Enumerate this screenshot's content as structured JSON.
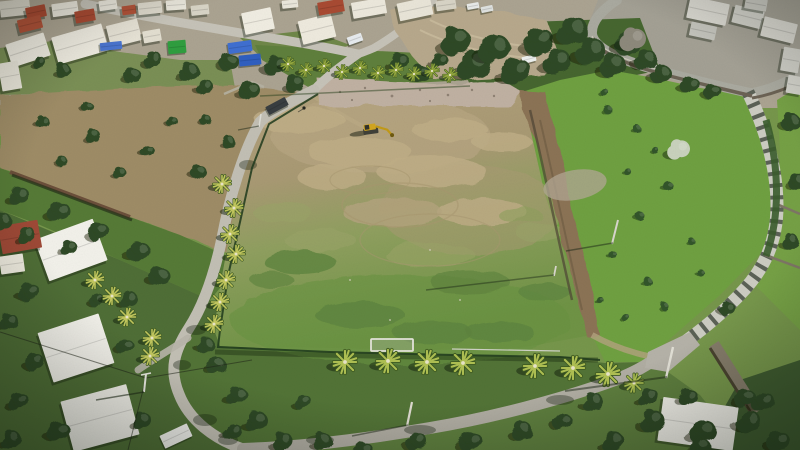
{
  "scene": {
    "type": "aerial-drone-photograph",
    "description": "Aerial drone view of a large cleared dirt and grass field ringed by palm trees and a chain-link fence, with a yellow excavator working near rubble at the top of the plot. A narrow road runs down the left side and curves around the bottom past white villas with red-roofed houses; on the right a stepped stone street descends between terraced gardens and bright green scrubland toward a white flat-roofed villa.",
    "lighting": "bright daylight, shadows falling to the lower-left",
    "landmarks": {
      "main_field": "large cleared plot, brown dirt upper half and patchy green lower half",
      "excavator": {
        "x": 371,
        "y": 129
      },
      "rubble_strip": "pinkish demolition debris along the top edge of the field",
      "goal_frame": {
        "x": 392,
        "y": 345
      },
      "stepped_street": "striped stone stairway street on the right side",
      "person": {
        "x": 304,
        "y": 109
      }
    }
  },
  "palette": {
    "field_dirt": "#b1a07c",
    "field_grass": "#6f9345",
    "scrub_green": "#6fa041",
    "tree_dark": "#2e4a25",
    "palm_light": "#b9c455",
    "road_concrete": "#c6c3b8",
    "road_asphalt": "#aaa79c",
    "building_white": "#f0ede2",
    "roof_red": "#a84a32",
    "rubble_pink": "#c0b1a2",
    "tarp_blue": "#3f6fd1",
    "container_green": "#2f9e3f",
    "excavator_yellow": "#d2a51f"
  },
  "instances": {
    "buildings": {
      "symbol": "box",
      "name": "building",
      "shadow": 2.5,
      "color": "#efece1",
      "items": [
        [
          15,
          8,
          30,
          16,
          -6,
          "#dcd8cb"
        ],
        [
          36,
          12,
          20,
          12,
          -12,
          "#a84a32"
        ],
        [
          30,
          24,
          24,
          13,
          -14,
          "#b05238"
        ],
        [
          65,
          9,
          26,
          13,
          -8,
          "#eae7dc"
        ],
        [
          85,
          16,
          20,
          12,
          -10,
          "#a84a32"
        ],
        [
          108,
          5,
          18,
          10,
          -8,
          "#eae7dc"
        ],
        [
          129,
          10,
          14,
          9,
          -8,
          "#b05238"
        ],
        [
          150,
          8,
          24,
          12,
          -6,
          "#dcd8cb"
        ],
        [
          176,
          5,
          20,
          10,
          -4,
          "#eae7dc"
        ],
        [
          200,
          10,
          18,
          10,
          -6,
          "#d8d4c6"
        ],
        [
          28,
          50,
          40,
          24,
          -18,
          "#efece1"
        ],
        [
          80,
          44,
          52,
          28,
          -16,
          "#efece1"
        ],
        [
          124,
          33,
          32,
          22,
          -14,
          "#e6e2d5"
        ],
        [
          10,
          76,
          20,
          28,
          -10,
          "#e9e6da"
        ],
        [
          152,
          36,
          18,
          12,
          -10,
          "#e2ded0"
        ],
        [
          258,
          21,
          30,
          22,
          -12,
          "#f0ede2"
        ],
        [
          317,
          29,
          34,
          24,
          -14,
          "#eeeade"
        ],
        [
          331,
          7,
          26,
          13,
          -10,
          "#a84a32"
        ],
        [
          369,
          8,
          34,
          16,
          -10,
          "#ece8dc"
        ],
        [
          415,
          9,
          34,
          18,
          -12,
          "#e9e5d8"
        ],
        [
          446,
          5,
          20,
          10,
          -8,
          "#d8d4c6"
        ],
        [
          290,
          4,
          16,
          8,
          -6,
          "#eae7dc"
        ],
        [
          708,
          11,
          40,
          22,
          12,
          "#d8d7cf"
        ],
        [
          748,
          17,
          30,
          18,
          14,
          "#cfcfc7"
        ],
        [
          779,
          30,
          34,
          20,
          14,
          "#d8d7cf"
        ],
        [
          791,
          60,
          18,
          24,
          10,
          "#cfcfc7"
        ],
        [
          756,
          4,
          22,
          12,
          10,
          "#c8c8c0"
        ],
        [
          703,
          31,
          26,
          14,
          12,
          "#c3c3bb"
        ],
        [
          795,
          85,
          16,
          18,
          10,
          "#d2d2ca"
        ],
        [
          71,
          250,
          62,
          44,
          -20,
          "#f2f1ea"
        ],
        [
          76,
          348,
          64,
          52,
          -18,
          "#f1f0e9"
        ],
        [
          100,
          418,
          68,
          52,
          -15,
          "#f0efe8"
        ],
        [
          20,
          237,
          40,
          28,
          -10,
          "#9e4936"
        ],
        [
          12,
          264,
          24,
          18,
          -8,
          "#ece9dd"
        ],
        [
          698,
          424,
          76,
          44,
          8,
          "#efeee7"
        ]
      ]
    },
    "vehicles": {
      "symbol": "box",
      "name": "vehicle",
      "shadow": 1.5,
      "color": "#e8eae8",
      "items": [
        [
          277,
          106,
          22,
          9,
          -28,
          "#383d40"
        ],
        [
          529,
          59,
          14,
          7,
          -15,
          "#edf0ee"
        ],
        [
          473,
          6,
          12,
          6,
          -10,
          "#e8eae8"
        ],
        [
          487,
          9,
          12,
          6,
          -12,
          "#dfe2e0"
        ],
        [
          355,
          39,
          15,
          8,
          -20,
          "#e7ebee"
        ],
        [
          176,
          436,
          30,
          14,
          -25,
          "#f0f0ec"
        ],
        [
          177,
          47,
          18,
          13,
          -5,
          "#2f9e3f"
        ],
        [
          240,
          47,
          24,
          11,
          -8,
          "#3f6fd1"
        ],
        [
          250,
          60,
          22,
          11,
          -6,
          "#2f5fc0"
        ],
        [
          111,
          46,
          22,
          8,
          -6,
          "#4a74cf"
        ]
      ]
    },
    "trees": {
      "symbol": "#tree",
      "name": "tree",
      "base": 1,
      "color": "#2e4a25",
      "items": [
        [
          455,
          42,
          1.6
        ],
        [
          472,
          66,
          1.8
        ],
        [
          494,
          50,
          1.7
        ],
        [
          515,
          72,
          1.6
        ],
        [
          538,
          42,
          1.6
        ],
        [
          556,
          62,
          1.5
        ],
        [
          572,
          32,
          1.7
        ],
        [
          590,
          52,
          1.6
        ],
        [
          612,
          66,
          1.4
        ],
        [
          628,
          44,
          1.4
        ],
        [
          645,
          60,
          1.2
        ],
        [
          660,
          74,
          1.1
        ],
        [
          690,
          86,
          1.0
        ],
        [
          712,
          92,
          0.9
        ],
        [
          275,
          66,
          1.2
        ],
        [
          294,
          84,
          1.0
        ],
        [
          398,
          62,
          1.1
        ],
        [
          420,
          74,
          1.0
        ],
        [
          438,
          60,
          0.9
        ],
        [
          152,
          60,
          1.0
        ],
        [
          188,
          72,
          1.1
        ],
        [
          228,
          62,
          1.0
        ],
        [
          248,
          90,
          1.1
        ],
        [
          132,
          76,
          0.9
        ],
        [
          205,
          88,
          0.9
        ],
        [
          62,
          70,
          0.8
        ],
        [
          38,
          62,
          0.7
        ],
        [
          42,
          122,
          0.7
        ],
        [
          92,
          136,
          0.8
        ],
        [
          148,
          152,
          0.7
        ],
        [
          198,
          172,
          0.8
        ],
        [
          118,
          172,
          0.7
        ],
        [
          62,
          162,
          0.6
        ],
        [
          172,
          122,
          0.6
        ],
        [
          228,
          142,
          0.7
        ],
        [
          88,
          108,
          0.6
        ],
        [
          205,
          120,
          0.6
        ],
        [
          18,
          196,
          1.1
        ],
        [
          58,
          212,
          1.2
        ],
        [
          98,
          232,
          1.1
        ],
        [
          138,
          252,
          1.2
        ],
        [
          26,
          236,
          1.0
        ],
        [
          2,
          222,
          1.0
        ],
        [
          158,
          276,
          1.1
        ],
        [
          128,
          300,
          1.0
        ],
        [
          68,
          248,
          0.9
        ],
        [
          28,
          292,
          1.1
        ],
        [
          8,
          322,
          1.0
        ],
        [
          34,
          362,
          1.0
        ],
        [
          18,
          402,
          1.1
        ],
        [
          58,
          432,
          1.2
        ],
        [
          124,
          346,
          0.9
        ],
        [
          142,
          422,
          1.0
        ],
        [
          10,
          440,
          1.1
        ],
        [
          96,
          300,
          0.8
        ],
        [
          216,
          366,
          1.0
        ],
        [
          236,
          396,
          1.1
        ],
        [
          256,
          422,
          1.2
        ],
        [
          282,
          442,
          1.1
        ],
        [
          302,
          402,
          0.9
        ],
        [
          232,
          432,
          1.0
        ],
        [
          205,
          345,
          0.9
        ],
        [
          322,
          442,
          1.0
        ],
        [
          362,
          450,
          1.0
        ],
        [
          416,
          442,
          1.1
        ],
        [
          470,
          442,
          1.2
        ],
        [
          522,
          432,
          1.1
        ],
        [
          562,
          422,
          1.0
        ],
        [
          592,
          402,
          1.1
        ],
        [
          612,
          442,
          1.2
        ],
        [
          652,
          422,
          1.3
        ],
        [
          702,
          432,
          1.4
        ],
        [
          748,
          422,
          1.3
        ],
        [
          778,
          442,
          1.2
        ],
        [
          762,
          402,
          1.2
        ],
        [
          688,
          398,
          1.0
        ],
        [
          648,
          398,
          1.1
        ],
        [
          744,
          398,
          1.1
        ],
        [
          700,
          448,
          1.1
        ],
        [
          790,
          122,
          1.0
        ],
        [
          796,
          182,
          0.9
        ],
        [
          790,
          242,
          0.9
        ],
        [
          726,
          308,
          0.8
        ]
      ]
    },
    "trees_special": {
      "symbol": "#tree",
      "name": "tree",
      "base": 1,
      "color": "#8d897b",
      "items": [
        [
          632,
          40,
          1.4,
          "#8d897b"
        ],
        [
          678,
          150,
          1.2,
          "#c9d2bd"
        ]
      ]
    },
    "bushes": {
      "symbol": "#bush",
      "name": "bush",
      "base": 1,
      "color": "#33552a",
      "items": [
        [
          608,
          110,
          1
        ],
        [
          638,
          130,
          0.9
        ],
        [
          668,
          186,
          1.1
        ],
        [
          640,
          216,
          1
        ],
        [
          614,
          256,
          0.9
        ],
        [
          648,
          282,
          1
        ],
        [
          664,
          306,
          0.9
        ],
        [
          700,
          272,
          0.8
        ],
        [
          604,
          92,
          0.9
        ],
        [
          690,
          240,
          0.8
        ],
        [
          628,
          172,
          0.8
        ],
        [
          600,
          300,
          0.8
        ],
        [
          626,
          318,
          0.9
        ],
        [
          655,
          150,
          0.8
        ]
      ]
    },
    "palms_top": {
      "symbol": "#palm",
      "name": "palm-tree",
      "base": 0.75,
      "color": "#95a83e",
      "items": [
        [
          288,
          64
        ],
        [
          306,
          70
        ],
        [
          324,
          66
        ],
        [
          342,
          72
        ],
        [
          360,
          68
        ],
        [
          378,
          73
        ],
        [
          396,
          70
        ],
        [
          414,
          74
        ],
        [
          432,
          71
        ],
        [
          450,
          75
        ]
      ]
    },
    "palms_left": {
      "symbol": "#palm",
      "name": "palm-tree",
      "base": 0.95,
      "color": "#c2c75e",
      "items": [
        [
          222,
          184
        ],
        [
          234,
          208
        ],
        [
          230,
          234
        ],
        [
          236,
          254
        ],
        [
          226,
          280
        ],
        [
          220,
          302
        ],
        [
          214,
          324
        ],
        [
          112,
          296
        ],
        [
          127,
          317
        ],
        [
          95,
          280
        ],
        [
          152,
          338
        ],
        [
          150,
          356
        ]
      ]
    },
    "palms_bottom": {
      "symbol": "#palm",
      "name": "palm-tree",
      "base": 1.25,
      "color": "#aebf52",
      "items": [
        [
          345,
          362
        ],
        [
          388,
          361
        ],
        [
          427,
          362
        ],
        [
          463,
          363
        ],
        [
          535,
          366
        ],
        [
          573,
          368
        ],
        [
          608,
          374
        ],
        [
          634,
          383,
          0.8
        ]
      ]
    }
  }
}
